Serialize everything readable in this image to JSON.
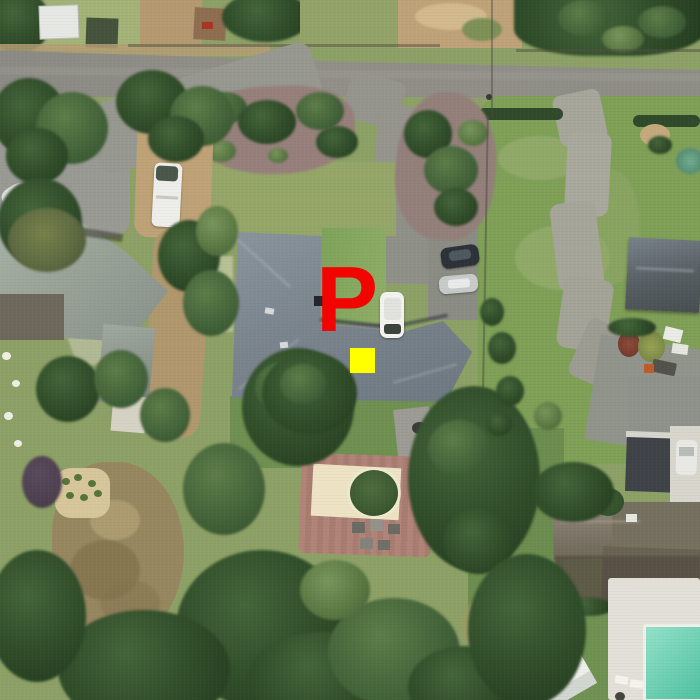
{
  "scene": {
    "type": "aerial-satellite-photo",
    "description": "Aerial view of a suburban neighborhood: street along the top, central house with gray hip roof, driveways, lawns, dense tree canopy, brick patio, neighboring houses, swimming pool at lower right, parked cars, RV and boat",
    "overlay": {
      "letter_marker": {
        "label": "P",
        "color": "#f20400"
      },
      "square_marker": {
        "color": "#ffff00"
      }
    }
  }
}
